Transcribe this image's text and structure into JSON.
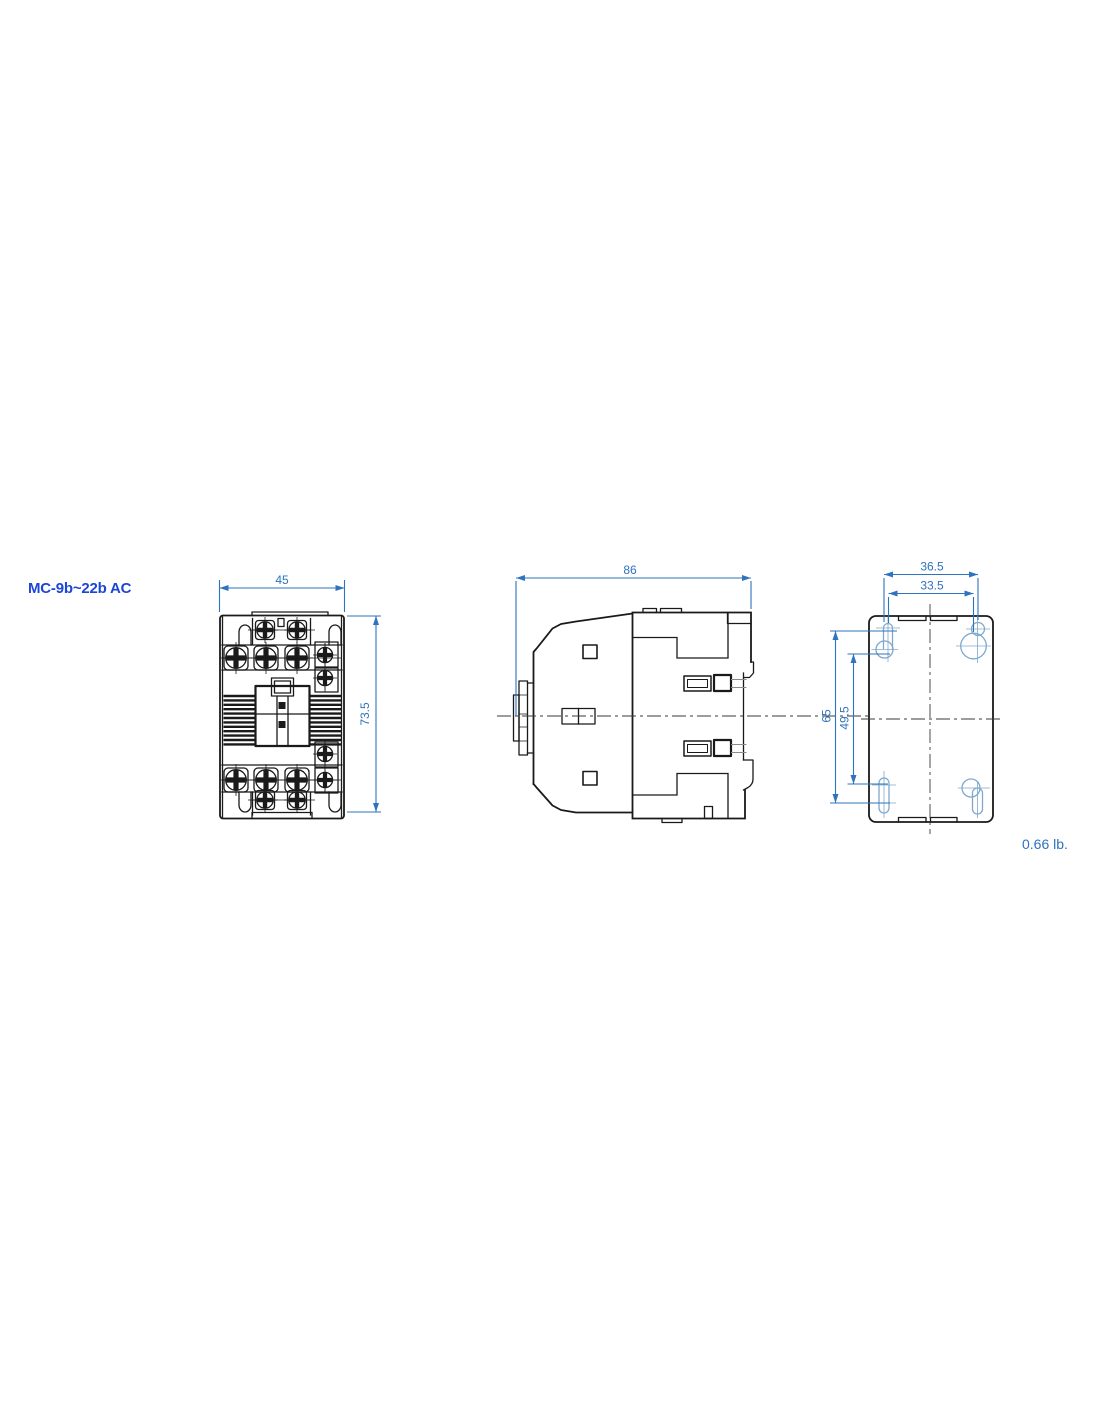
{
  "drawing": {
    "title": "MC-9b~22b AC",
    "weight_note": "0.66 lb.",
    "dimensions": {
      "front_width": "45",
      "front_height": "73.5",
      "side_depth": "86",
      "mount_width_outer": "36.5",
      "mount_width_inner": "33.5",
      "mount_height_outer": "65",
      "mount_height_inner": "49.5"
    },
    "colors": {
      "dimension_blue": "#2d73bd",
      "title_blue": "#1c46d6",
      "outline_black": "#1a1a1a",
      "mount_hole_blue": "#7fa8cd"
    }
  }
}
